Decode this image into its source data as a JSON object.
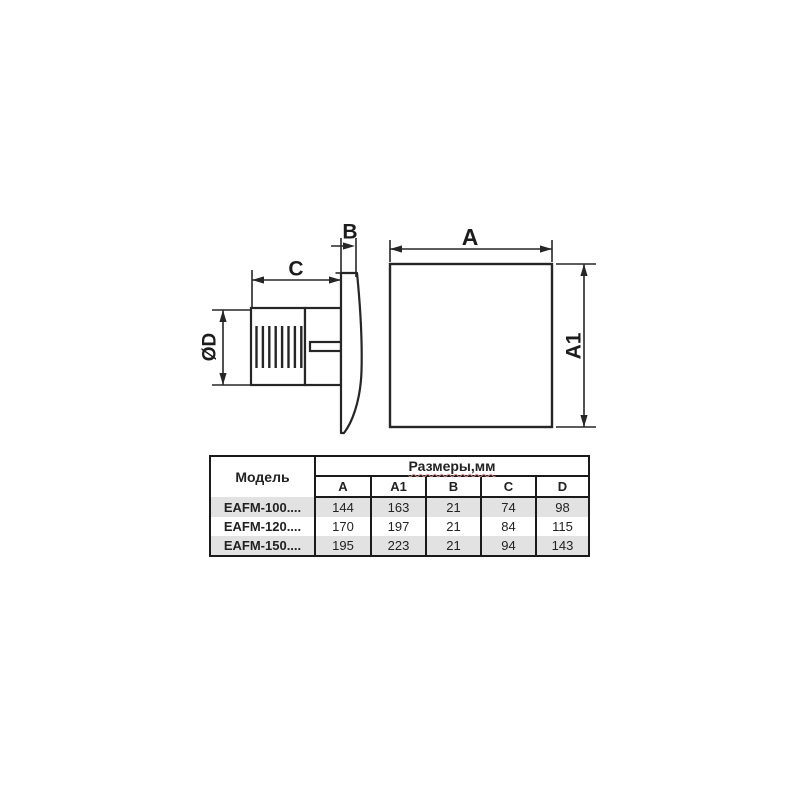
{
  "colors": {
    "background": "#ffffff",
    "line": "#262626",
    "text": "#1c1c1c",
    "table_border": "#1a1a1a",
    "row_alt_bg": "#e2e2e2",
    "spellcheck_underline": "#d98c8c"
  },
  "diagram": {
    "side_view": {
      "label_duct_diameter": "ØD",
      "label_depth": "C",
      "label_panel_thickness": "B"
    },
    "front_view": {
      "label_width": "A",
      "label_height": "A1"
    }
  },
  "table": {
    "header_model": "Модель",
    "header_dimensions_group": "Размеры,мм",
    "dimension_columns": [
      "A",
      "A1",
      "B",
      "C",
      "D"
    ],
    "rows": [
      {
        "model": "EAFM-100....",
        "values": [
          "144",
          "163",
          "21",
          "74",
          "98"
        ]
      },
      {
        "model": "EAFM-120....",
        "values": [
          "170",
          "197",
          "21",
          "84",
          "115"
        ]
      },
      {
        "model": "EAFM-150....",
        "values": [
          "195",
          "223",
          "21",
          "94",
          "143"
        ]
      }
    ]
  }
}
